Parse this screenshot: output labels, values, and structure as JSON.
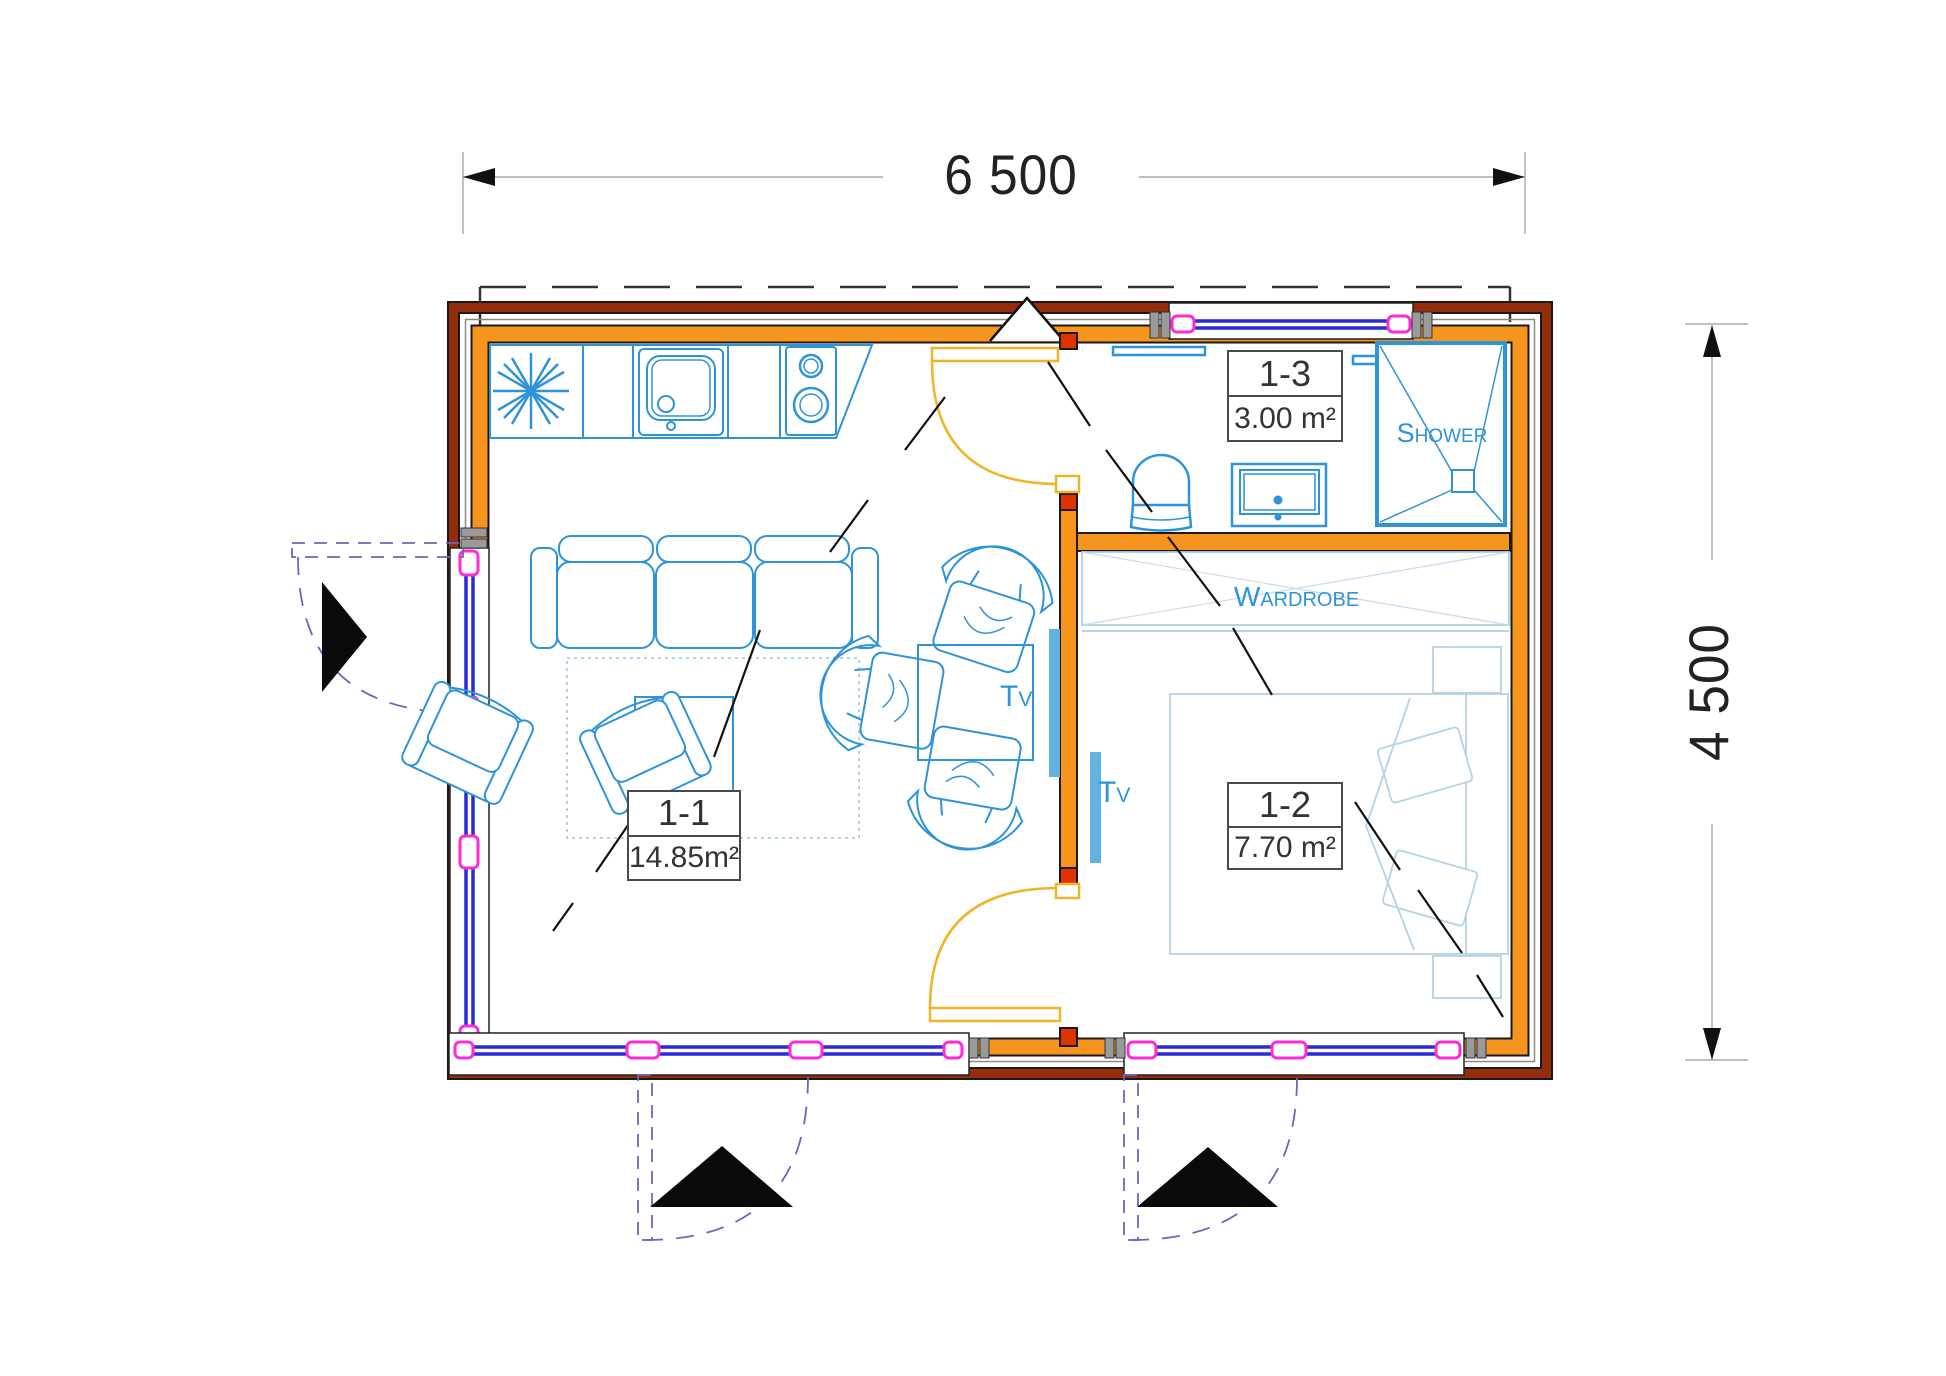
{
  "plan": {
    "title": "cabin-floor-plan",
    "dimensions": {
      "width": "6 500",
      "height": "4 500"
    },
    "rooms": [
      {
        "id": "1-1",
        "area": "14.85m²"
      },
      {
        "id": "1-2",
        "area": "7.70 m²"
      },
      {
        "id": "1-3",
        "area": "3.00 m²"
      }
    ],
    "fixture_labels": {
      "shower": "Shower",
      "wardrobe": "Wardrobe",
      "tv_living": "Tv",
      "tv_bedroom": "Tv"
    },
    "colors": {
      "wall_orange": "#F7941E",
      "wall_outer_red": "#932D0E",
      "door_jamb_red": "#E03400",
      "fixture_blue": "#2E93D8",
      "soft_blue": "#A9CFE6",
      "glazing_blue": "#2A2AD8",
      "connector_magenta": "#FF2BD6",
      "door_leaf_yellow": "#F0B429",
      "swing_purple": "#6F63BE",
      "tv_fill": "#62B2E0"
    }
  }
}
